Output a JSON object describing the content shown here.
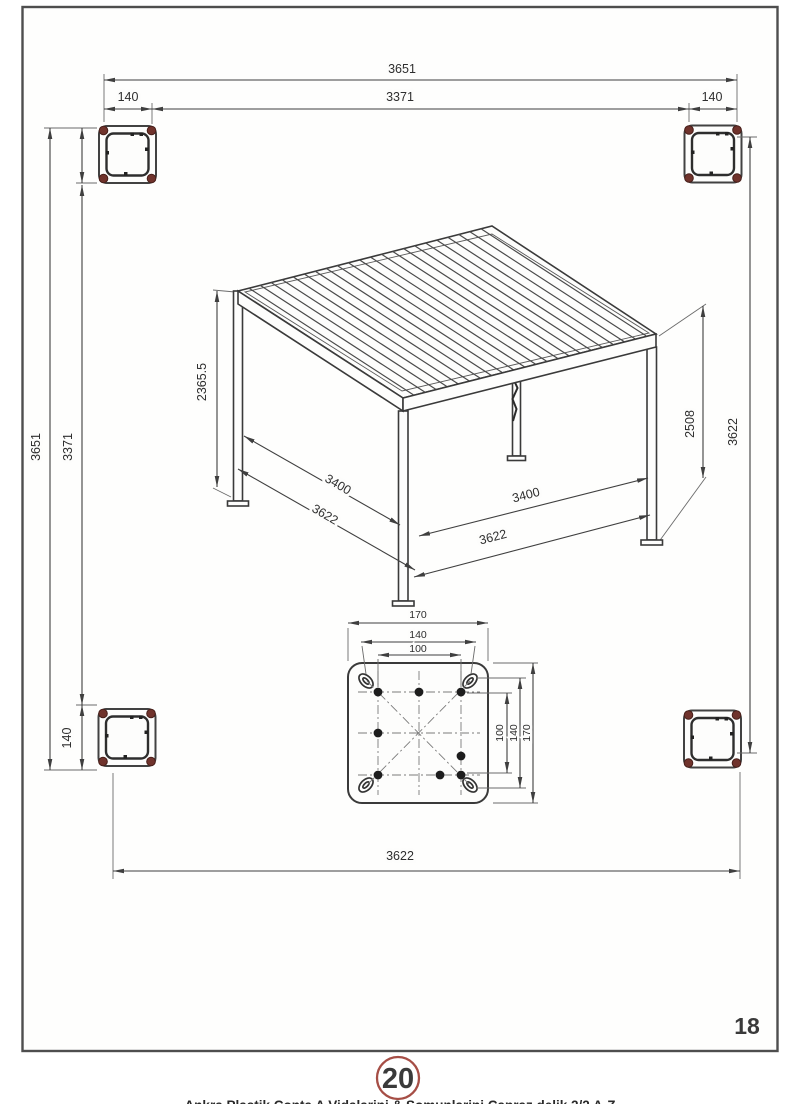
{
  "page": {
    "sheet_number": "18",
    "step_badge": "20",
    "footer_caption": "Ankra  Plastik Conta  A  Vidalarini & Somunlarini  Capraz  delik  2/2 A-Z",
    "accent_red": "#a64e46",
    "line_color": "#3f3f3f"
  },
  "plan": {
    "top_total": "3651",
    "top_inner": "3371",
    "top_left_offset": "140",
    "top_right_offset": "140",
    "left_total": "3651",
    "left_inner": "3371",
    "left_bottom_offset": "140",
    "right_span": "3622",
    "bottom_span": "3622"
  },
  "pergola": {
    "height_total": "2365.5",
    "post_height": "2508",
    "left_span_inner": "3400",
    "left_span_outer": "3622",
    "right_span_inner": "3400",
    "right_span_outer": "3622"
  },
  "base_plate": {
    "top_outer": "170",
    "top_mid": "140",
    "top_inner": "100",
    "right_outer": "170",
    "right_mid": "140",
    "right_inner": "100"
  }
}
